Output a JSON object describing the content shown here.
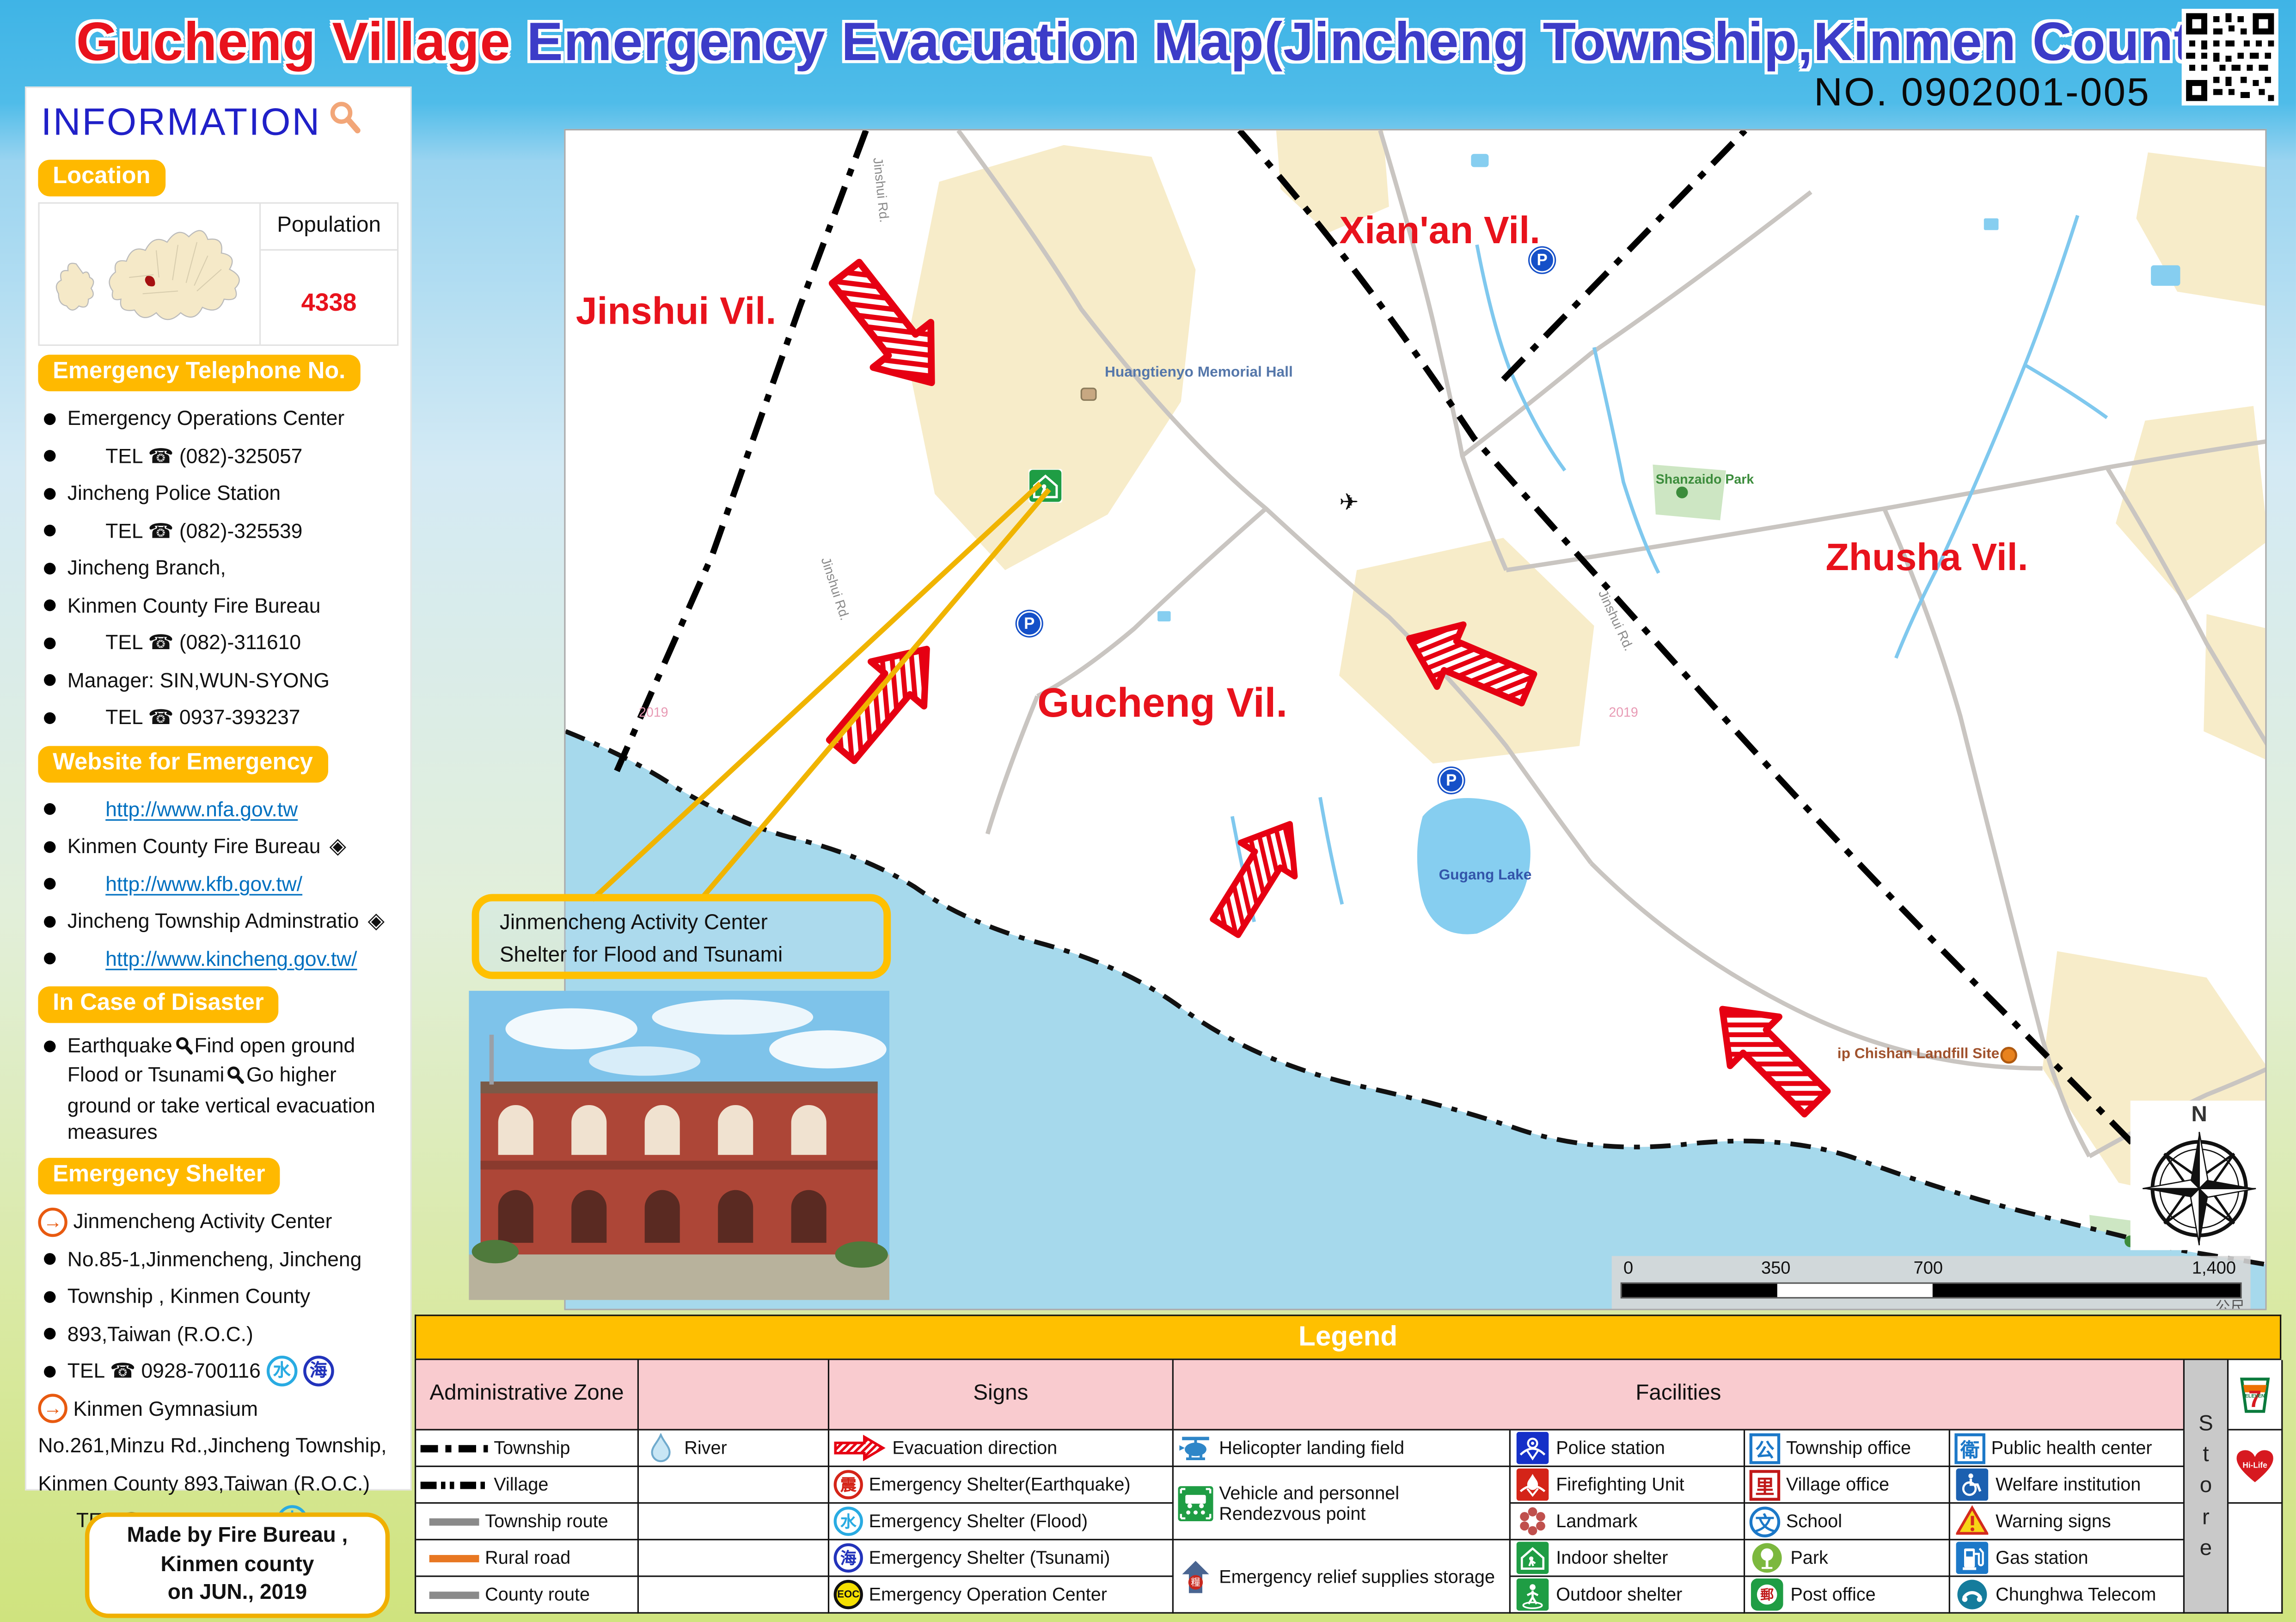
{
  "title": {
    "highlight": "Gucheng Village",
    "rest": " Emergency Evacuation Map(Jincheng Township,Kinmen County)",
    "doc_no": "NO. 0902001-005"
  },
  "sidebar": {
    "header": "INFORMATION",
    "location": {
      "badge": "Location",
      "population_label": "Population",
      "population_value": "4338"
    },
    "telephone": {
      "badge": "Emergency Telephone No.",
      "items": [
        "Emergency Operations Center",
        "TEL ☎ (082)-325057",
        "Jincheng Police Station",
        "TEL ☎ (082)-325539",
        "Jincheng Branch,",
        "Kinmen County Fire Bureau",
        "TEL ☎ (082)-311610",
        "Manager: SIN,WUN-SYONG",
        "TEL ☎ 0937-393237"
      ]
    },
    "website": {
      "badge": "Website for Emergency",
      "items": [
        "http://www.nfa.gov.tw",
        "Kinmen County Fire Bureau",
        "http://www.kfb.gov.tw/",
        "Jincheng Township Adminstratio",
        "http://www.kincheng.gov.tw/"
      ]
    },
    "disaster": {
      "badge": "In Case of Disaster",
      "seg1": "Earthquake",
      "seg2": "Find open ground Flood or Tsunami",
      "seg3": "Go higher ground or take vertical evacuation measures"
    },
    "shelter": {
      "badge": "Emergency Shelter",
      "items": [
        "Jinmencheng Activity Center",
        "No.85-1,Jinmencheng, Jincheng",
        "Township , Kinmen County",
        "893,Taiwan (R.O.C.)",
        "TEL ☎  0928-700116",
        "Kinmen Gymnasium",
        "No.261,Minzu Rd.,Jincheng Township,",
        "Kinmen County 893,Taiwan (R.O.C.)",
        "TEL ☎  0928-390383"
      ],
      "flood_char": "水",
      "sea_char": "海"
    },
    "madeby": {
      "line1": "Made by Fire Bureau ,",
      "line2": "Kinmen county",
      "line3": "on JUN., 2019"
    }
  },
  "map": {
    "villages": [
      "Jinshui Vil.",
      "Xian'an Vil.",
      "Zhusha Vil.",
      "Gucheng Vil."
    ],
    "pois": {
      "memorial": "Huangtienyo Memorial Hall",
      "park": "Shanzaido Park",
      "lake": "Gugang Lake",
      "landfill": "ip Chishan Landfill Site"
    },
    "road_label": "Jinshui Rd.",
    "parking": "P",
    "watermark": "2019",
    "callout": {
      "line1": "Jinmencheng Activity Center",
      "line2": "Shelter for Flood and Tsunami"
    },
    "scalebar": {
      "t0": "0",
      "t1": "350",
      "t2": "700",
      "t3": "1,400",
      "unit": "公尺"
    },
    "compass_n": "N"
  },
  "legend": {
    "title": "Legend",
    "headers": {
      "admin": "Administrative Zone",
      "signs": "Signs",
      "facilities": "Facilities"
    },
    "admin_rows": [
      "Township",
      "Village",
      "Township route",
      "Rural road",
      "County route"
    ],
    "river": "River",
    "signs": [
      "Evacuation direction",
      "Emergency Shelter(Earthquake)",
      "Emergency Shelter (Flood)",
      "Emergency Shelter (Tsunami)",
      "Emergency Operation Center"
    ],
    "fac1": [
      "Helicopter landing field",
      "Vehicle and personnel Rendezvous point",
      "Emergency relief supplies storage"
    ],
    "fac2": [
      "Police station",
      "Firefighting Unit",
      "Landmark",
      "Indoor shelter",
      "Outdoor shelter"
    ],
    "fac3": [
      "Township office",
      "Village office",
      "School",
      "Park",
      "Post office"
    ],
    "fac4": [
      "Public health center",
      "Welfare institution",
      "Warning signs",
      "Gas station",
      "Chunghwa Telecom"
    ],
    "chars": {
      "earthquake": "震",
      "flood": "水",
      "tsunami": "海",
      "eoc": "EOC",
      "supplies": "糧",
      "township": "公",
      "village": "里",
      "school": "文",
      "post": "郵",
      "health": "衛"
    },
    "store": {
      "label_chars": [
        "S",
        "t",
        "o",
        "r",
        "e"
      ],
      "seven": "7",
      "seven_sub": "ELEVEN",
      "hilife": "Hi-Life"
    }
  },
  "colors": {
    "accent_orange": "#FFB900",
    "legend_yellow": "#FFC000",
    "header_pink": "#F9CBCF",
    "title_red": "#E8121C",
    "title_blue": "#3C3CC8",
    "link_blue": "#0070C0",
    "arrow_red": "#E60012",
    "sea": "#A6D9EC",
    "urban": "#F7ECC9"
  }
}
